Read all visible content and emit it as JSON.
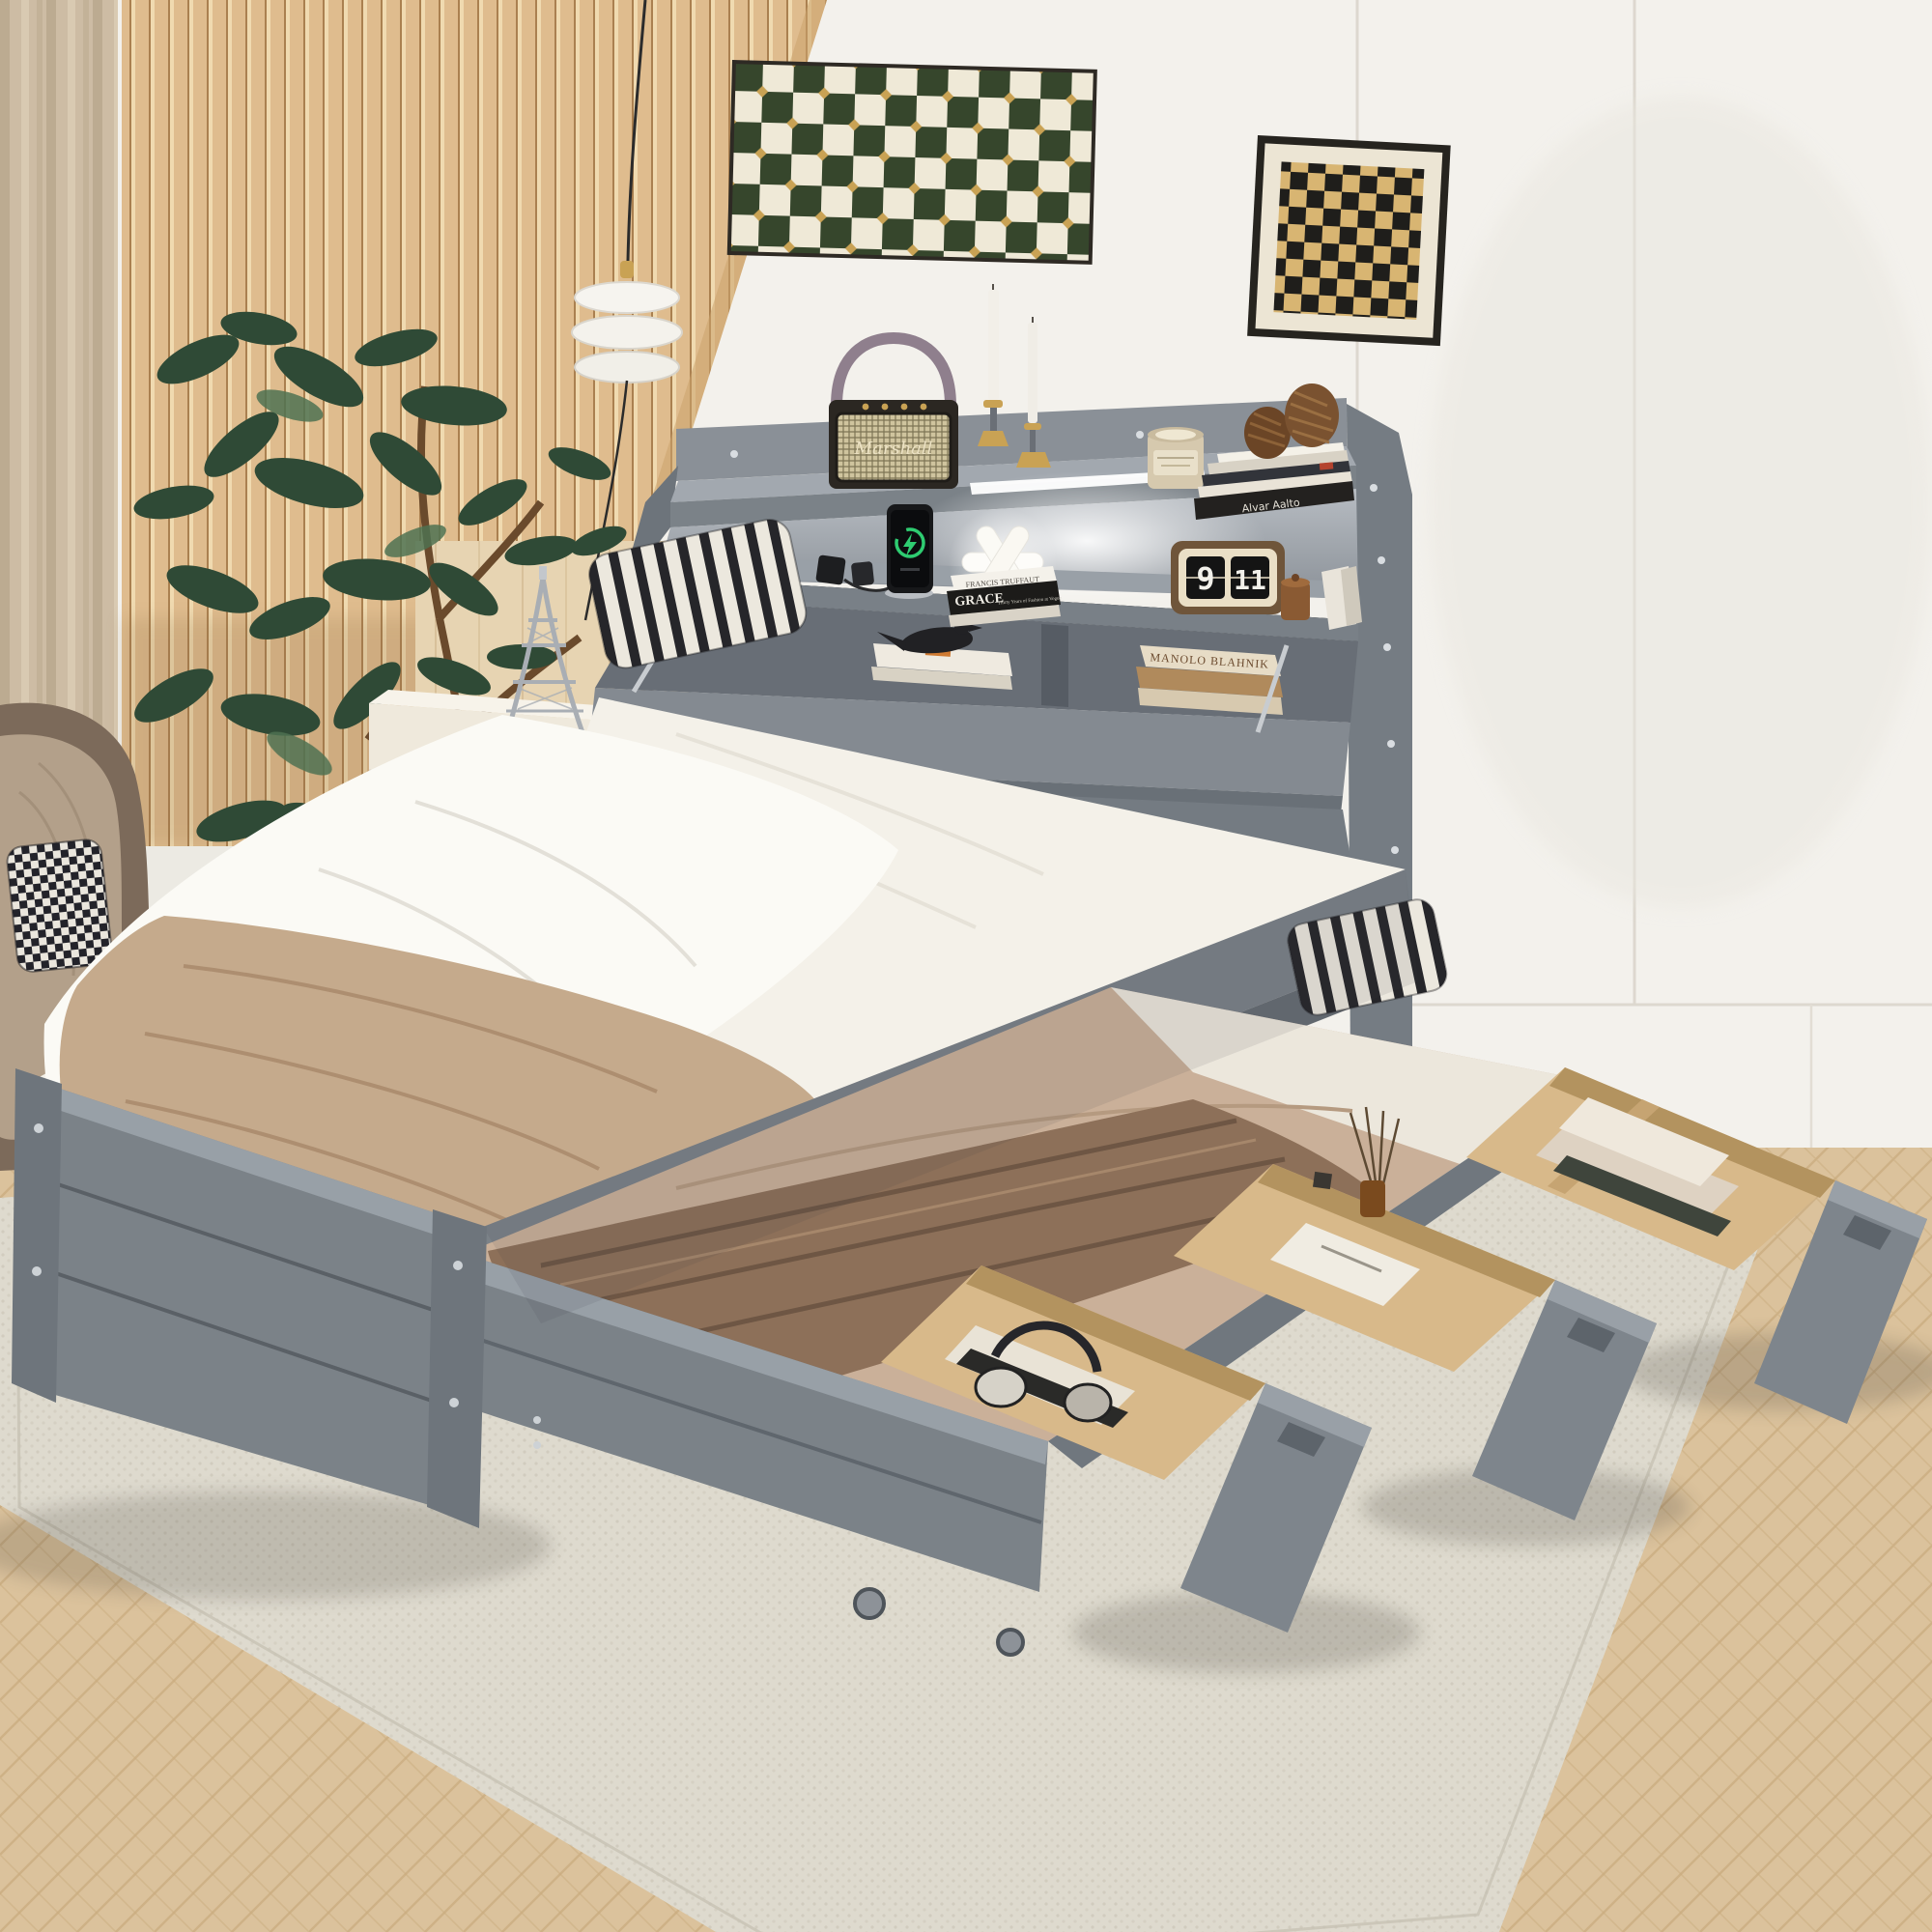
{
  "scene": {
    "description": "Bedroom product photo: gray twin bed with storage bookcase headboard, pull-out trundle and three open storage drawers"
  },
  "labels": {
    "speaker_brand": "Marshall",
    "book_spine_truffaut": "FRANCIS TRUFFAUT",
    "book_spine_grace": "GRACE",
    "book_spine_grace_sub": "Thirty Years of Fashion at Vogue",
    "book_cover_manolo": "MANOLO BLAHNIK",
    "book_spine_alvar": "Alvar Aalto"
  },
  "clock": {
    "hour": "9",
    "minute": "11"
  },
  "colors": {
    "wall_white": "#f3f1ec",
    "slat_wood": "#dfbc8e",
    "floor_wood": "#dbc29c",
    "rug": "#dedace",
    "bed_gray": "#7b8288",
    "bed_gray_dark": "#5f656c",
    "bed_gray_light": "#99a0a7",
    "mattress_white": "#f4f1e9",
    "duvet_white": "#fbfaf5",
    "blanket_tan": "#c5aa8c",
    "blanket_velvet": "#8d7059",
    "trundle_tan": "#cab099",
    "drawer_wood": "#d8b98a",
    "art_green": "#36462c",
    "art_gold": "#c9a254",
    "plant_green": "#2f4a36",
    "basket_tan": "#c69a60",
    "charge_green": "#2ecc71"
  }
}
